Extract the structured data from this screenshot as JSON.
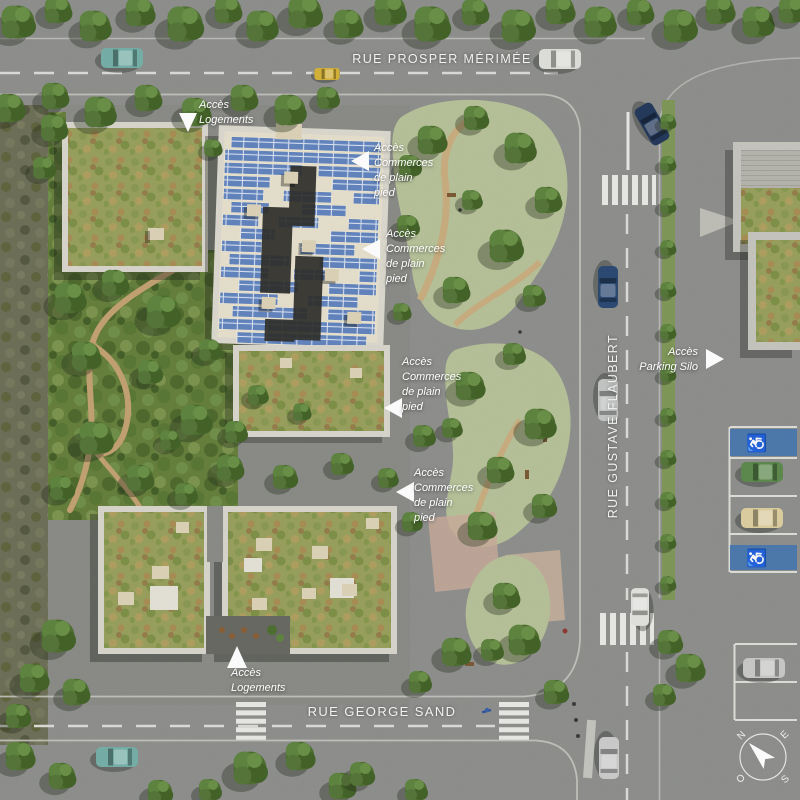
{
  "streets": {
    "top": "RUE PROSPER MÉRIMÉE",
    "right": "RUE GUSTAVE FLAUBERT",
    "bottom": "RUE GEORGE SAND"
  },
  "annotations": {
    "logements_top": "Accès\nLogements",
    "commerces_1": "Accès\nCommerces\nde plain\npied",
    "commerces_2": "Accès\nCommerces\nde plain\npied",
    "commerces_3": "Accès\nCommerces\nde plain\npied",
    "commerces_4": "Accès\nCommerces\nde plain\npied",
    "parking_silo": "Accès\nParking Silo",
    "logements_bottom": "Accès\nLogements"
  },
  "compass": {
    "n": "N",
    "e": "E",
    "s": "S",
    "o": "O"
  },
  "icons": {
    "disabled_parking": "♿"
  },
  "colors": {
    "asphalt": "#8f908e",
    "marking_white": "#e9e9e6",
    "parapet": "#d9d7cd",
    "roof_deck": "#e6e0cd",
    "solar_panel": "#6b8cc4",
    "sedum_roof": "#99a15e",
    "park_green": "#66803d",
    "planted_sage": "#b7c29a",
    "path_tan": "#c9ae80",
    "disabled_blue": "#4d79ad"
  }
}
